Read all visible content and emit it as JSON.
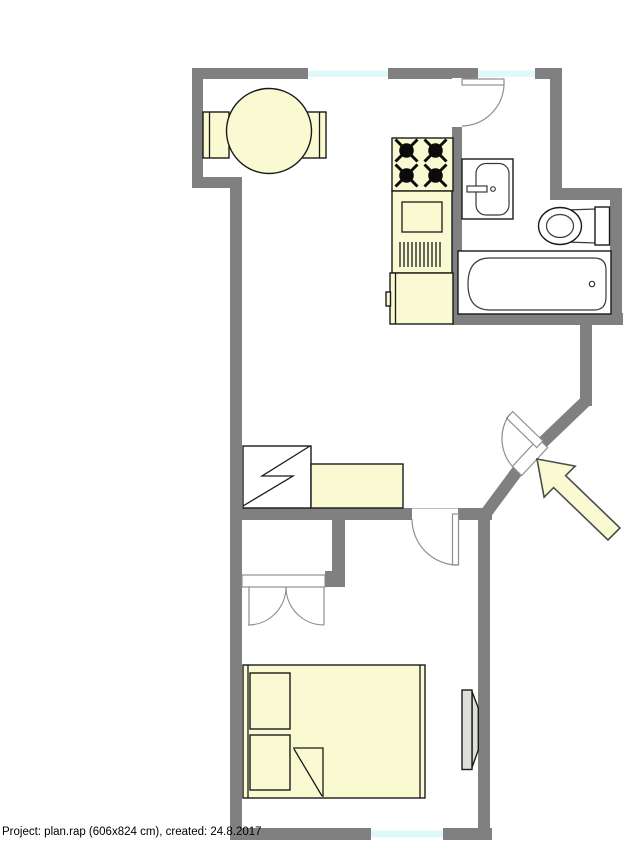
{
  "footer": {
    "label": "Project: plan.rap (606x824 cm), created: 24.8.2017"
  },
  "colors": {
    "wall": "#808080",
    "furniture": "#fafad2",
    "window": "#dff8fa",
    "outline": "#1a1a1a",
    "door": "#8f8f8f",
    "radiator": "#dededa",
    "arrowline": "#4d4d4d",
    "text": "#000000"
  },
  "plan": {
    "windows": [
      "top-left-window",
      "top-right-window",
      "bedroom-window"
    ],
    "doors": [
      "bathroom-door",
      "entrance-door",
      "bedroom-door",
      "closet-double-door"
    ],
    "furniture": [
      "dining-chair-left",
      "dining-chair-right",
      "dining-table",
      "stove",
      "kitchen-counter",
      "refrigerator",
      "bathroom-sink",
      "toilet",
      "bathtub",
      "wardrobe",
      "sideboard",
      "closet",
      "bed",
      "pillow-top",
      "pillow-bottom",
      "radiator",
      "entrance-arrow"
    ]
  }
}
